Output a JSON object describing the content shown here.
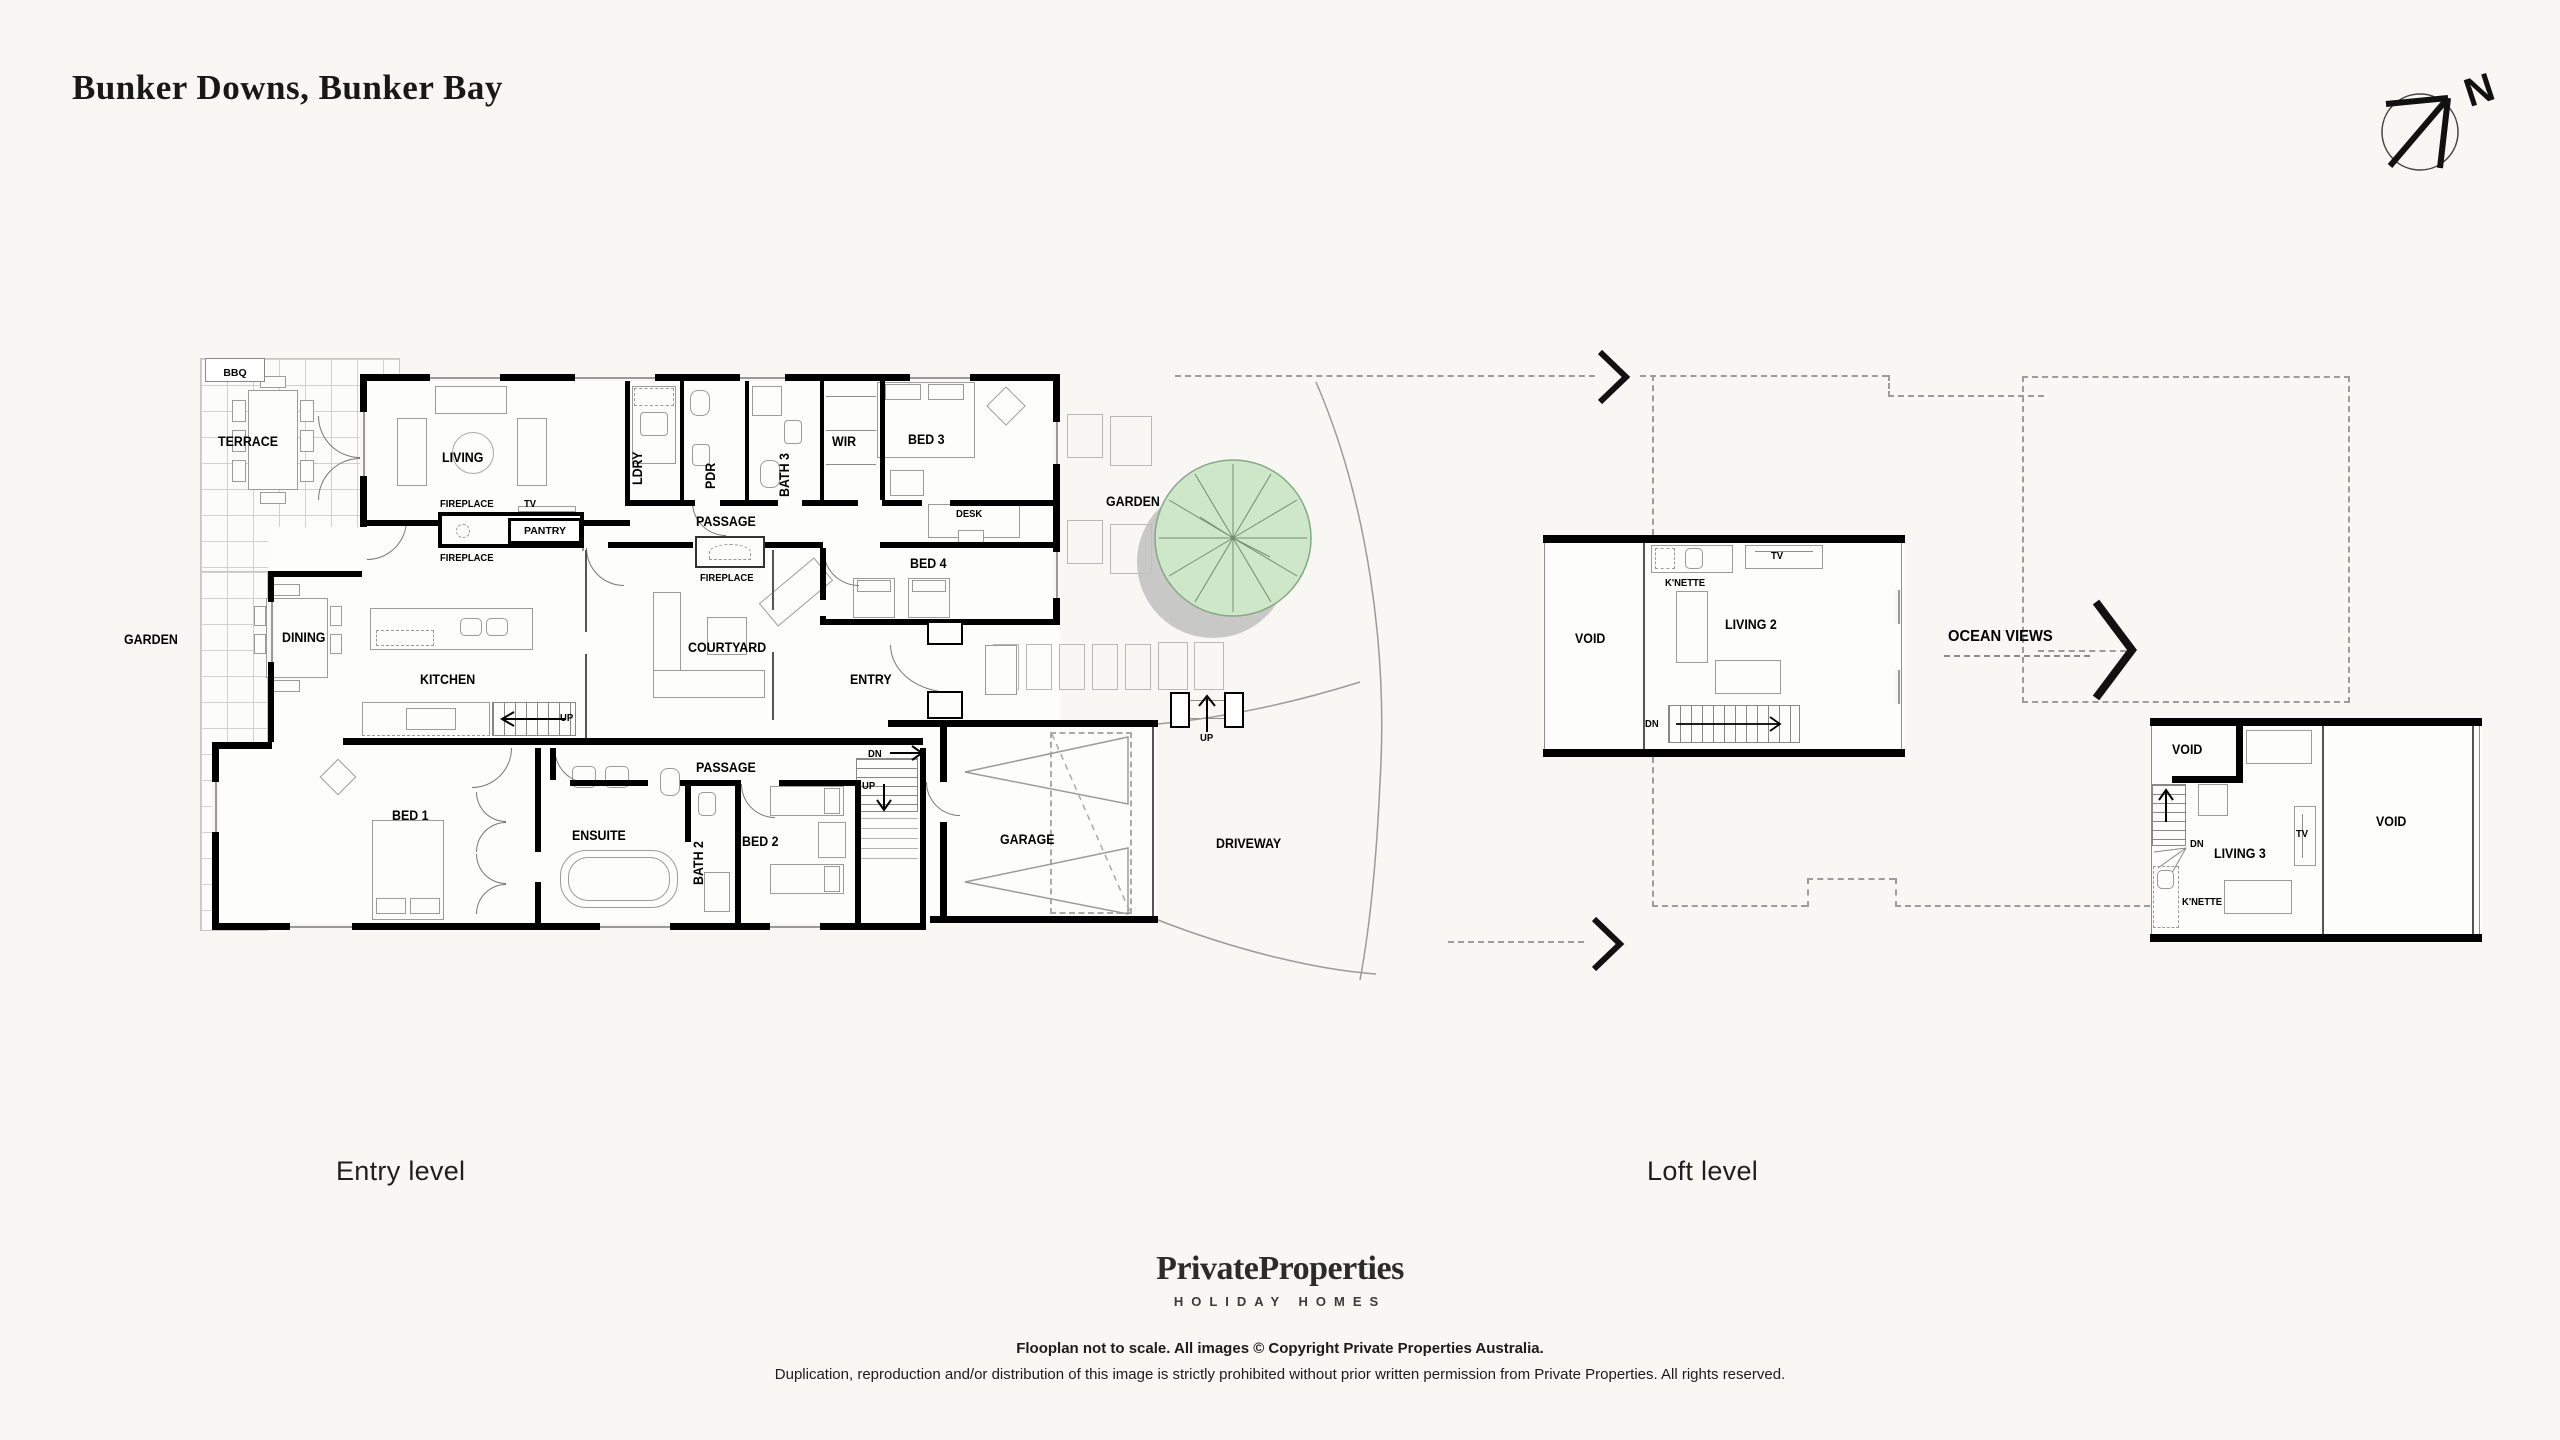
{
  "title": "Bunker Downs, Bunker Bay",
  "compass": {
    "north_letter": "N"
  },
  "colors": {
    "background": "#f8f7f4",
    "wall": "#000000",
    "dashed_roofline": "#9c9c9c",
    "tree_fill": "#cfe7c9",
    "tree_stroke": "#86a886",
    "tree_shadow": "#c0c0bd"
  },
  "entry": {
    "caption": "Entry level",
    "labels": {
      "bbq": "BBQ",
      "terrace": "TERRACE",
      "living": "LIVING",
      "ldry": "LDRY",
      "pdr": "PDR",
      "bath3": "BATH 3",
      "wir": "WIR",
      "bed3": "BED 3",
      "garden_right": "GARDEN",
      "fireplace_top": "FIREPLACE",
      "tv": "TV",
      "pantry": "PANTRY",
      "fireplace_bottom": "FIREPLACE",
      "passage_top": "PASSAGE",
      "garden_left": "GARDEN",
      "dining": "DINING",
      "kitchen": "KITCHEN",
      "courtyard": "COURTYARD",
      "fireplace_courtyard": "FIREPLACE",
      "bed4": "BED 4",
      "desk": "DESK",
      "entry": "ENTRY",
      "up_kitchen": "UP",
      "passage_bottom": "PASSAGE",
      "bed1": "BED 1",
      "ensuite": "ENSUITE",
      "bath2": "BATH 2",
      "bed2": "BED 2",
      "dn_stairs": "DN",
      "up_stairs": "UP",
      "garage": "GARAGE",
      "driveway": "DRIVEWAY",
      "up_driveway": "UP"
    }
  },
  "loft": {
    "caption": "Loft level",
    "labels": {
      "void_left": "VOID",
      "knette_1": "K'NETTE",
      "tv_1": "TV",
      "living2": "LIVING 2",
      "dn_1": "DN",
      "ocean_views": "OCEAN VIEWS",
      "void_top": "VOID",
      "living3": "LIVING 3",
      "tv_2": "TV",
      "dn_2": "DN",
      "knette_2": "K'NETTE",
      "void_right": "VOID"
    }
  },
  "brand": {
    "name": "PrivateProperties",
    "tagline": "HOLIDAY HOMES"
  },
  "footer": {
    "line1": "Flooplan not to scale. All images © Copyright Private Properties Australia.",
    "line2": "Duplication, reproduction and/or distribution of this image is strictly prohibited without prior written permission from Private Properties. All rights reserved."
  }
}
